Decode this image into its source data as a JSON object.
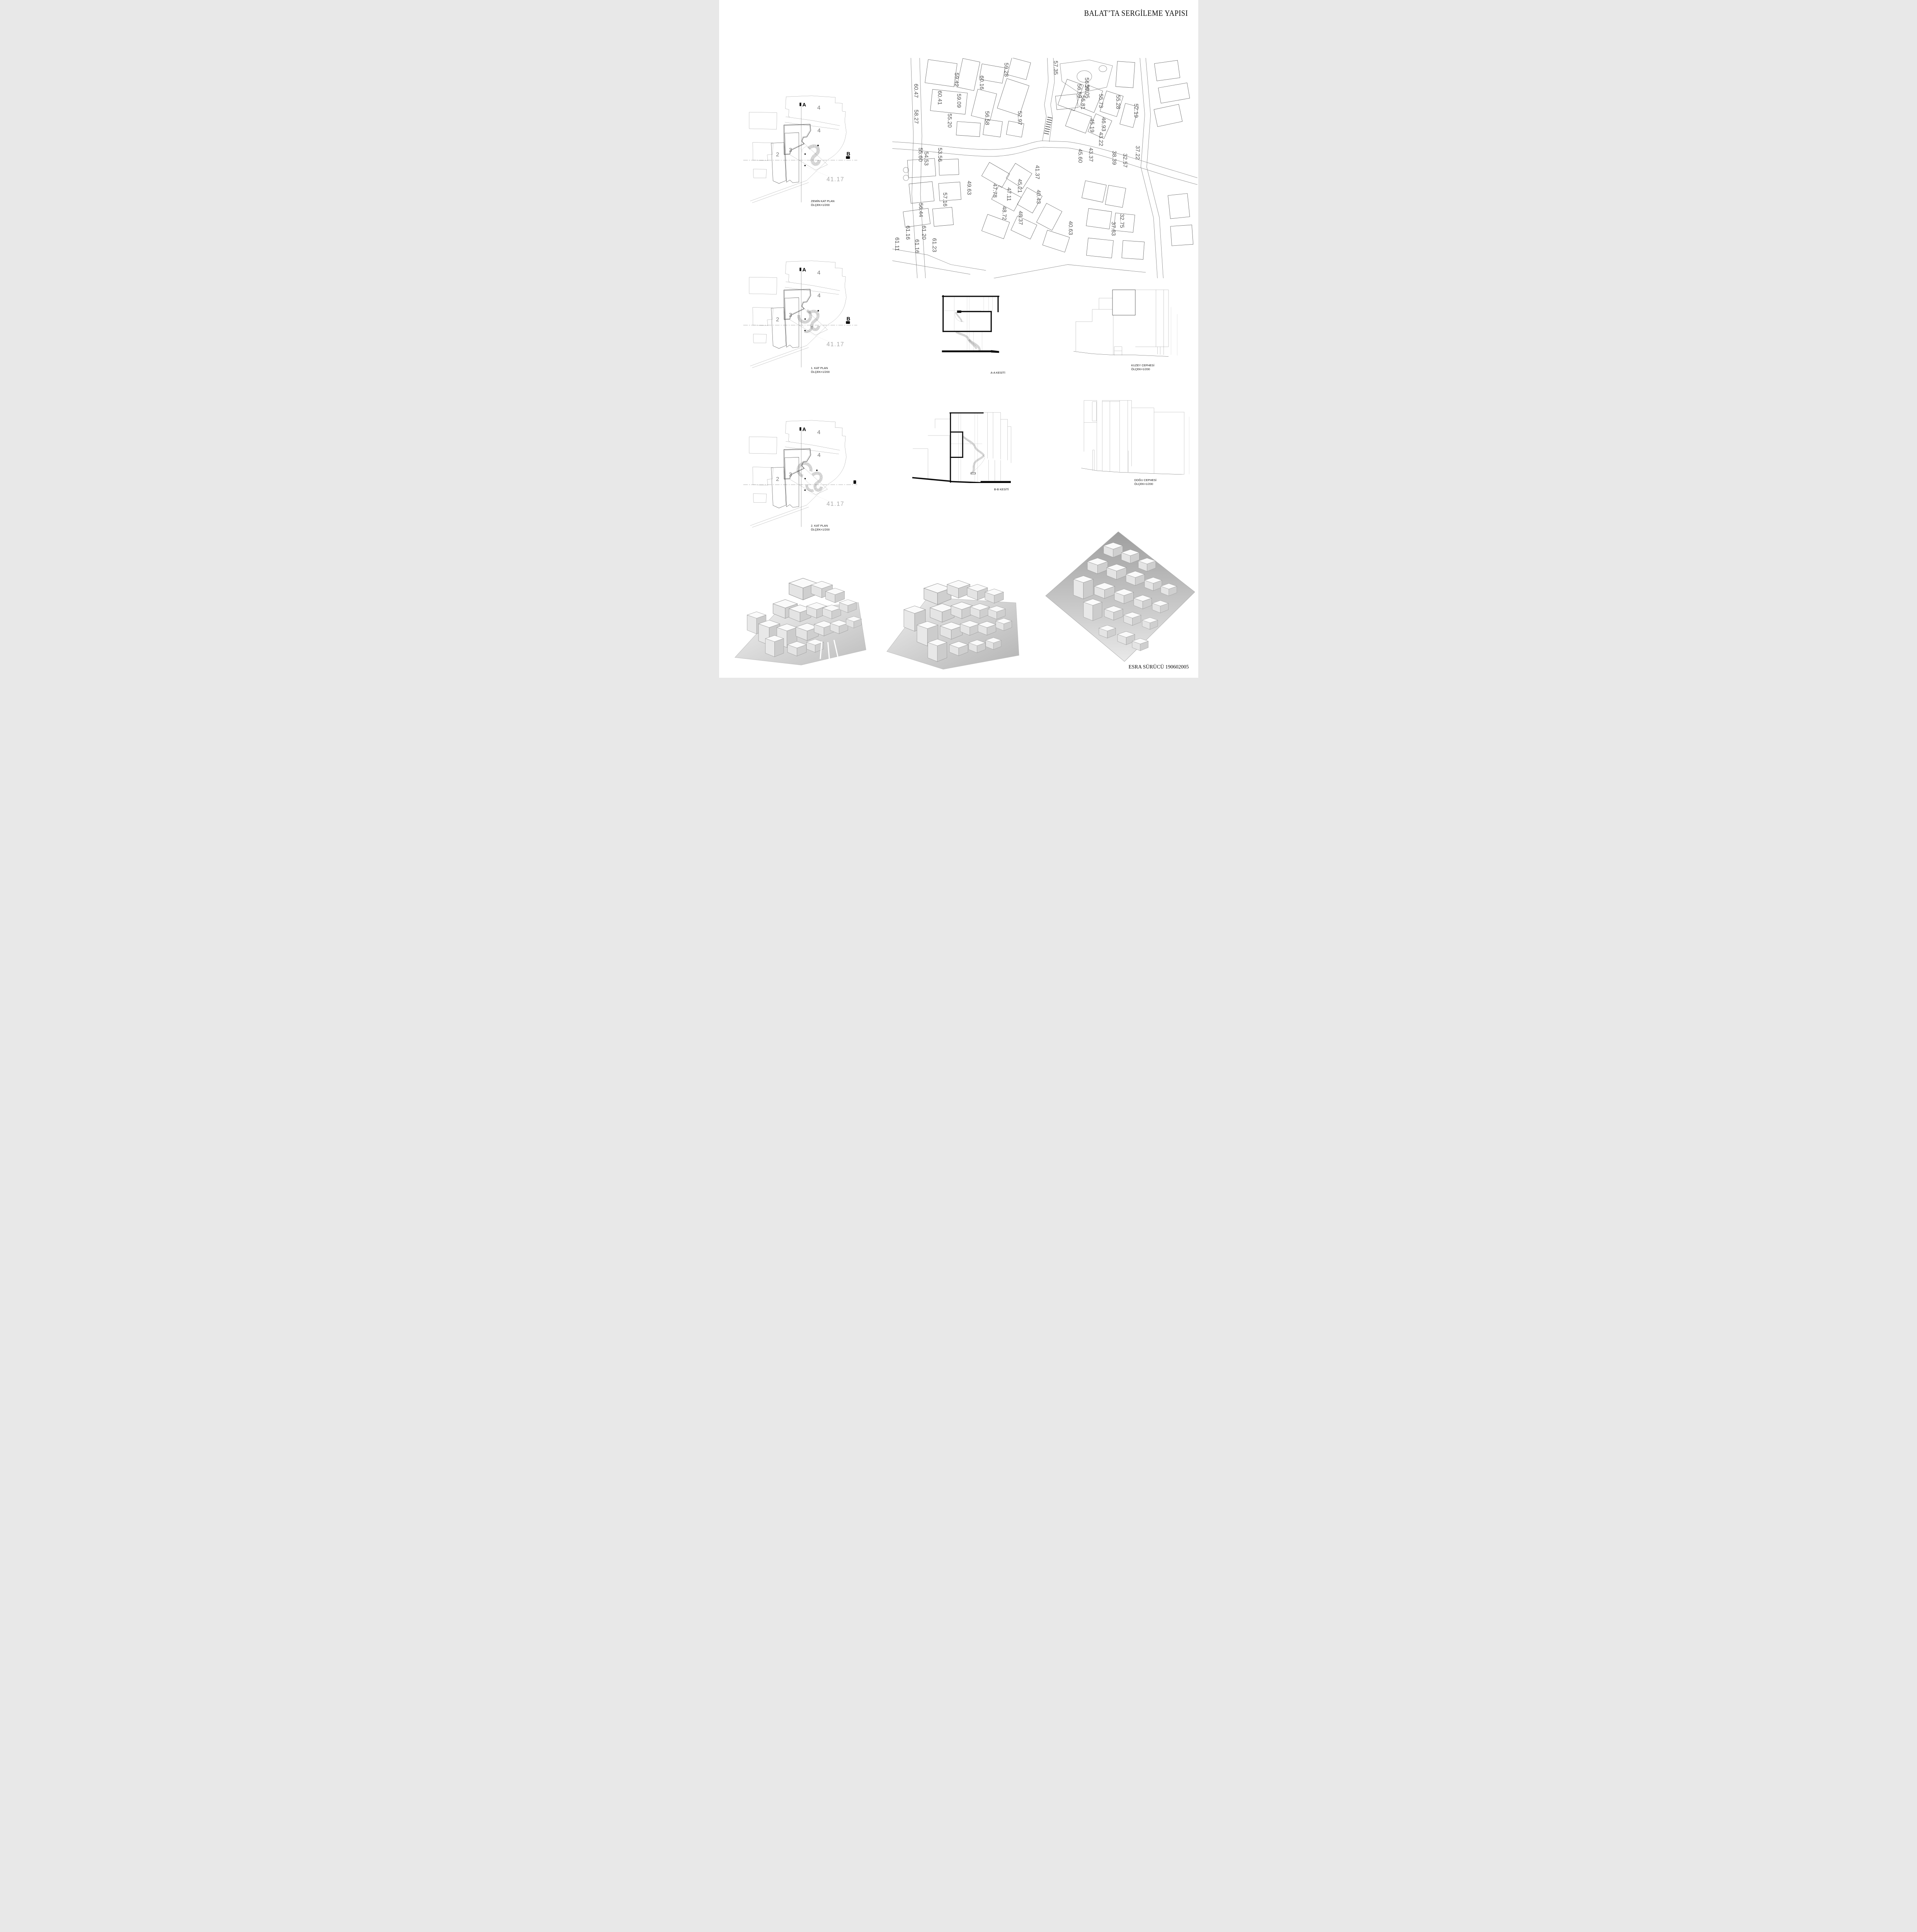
{
  "title": "BALAT’TA SERGİLEME YAPISI",
  "credit": "ESRA SÜRÜCÜ 190602005",
  "plans": [
    {
      "label": "ZEMİN  KAT PLAN",
      "scale": "ÖLÇEK=1/200",
      "marker_a": "A",
      "marker_b": "B",
      "parcel_top": "4",
      "parcel_mid": "4",
      "parcel_3": "3",
      "parcel_2": "2",
      "spot_elevation": "41.17"
    },
    {
      "label": "1. KAT PLAN",
      "scale": "ÖLÇEK=1/200",
      "marker_a": "A",
      "marker_b": "B",
      "parcel_top": "4",
      "parcel_mid": "4",
      "parcel_3": "3",
      "parcel_2": "2",
      "spot_elevation": "41.17"
    },
    {
      "label": "2. KAT PLAN",
      "scale": "ÖLÇEK=1/200",
      "marker_a": "A",
      "marker_b": "",
      "parcel_top": "4",
      "parcel_mid": "4",
      "parcel_3": "3",
      "parcel_2": "2",
      "spot_elevation": "41.17"
    }
  ],
  "sections": [
    {
      "label": "A-A KESİTİ"
    },
    {
      "label": "B-B KESİTİ"
    }
  ],
  "elevations": [
    {
      "label": "KUZEY CEPHESİ",
      "scale": "ÖLÇEK=1/200"
    },
    {
      "label": "DOĞU CEPHESİ",
      "scale": "ÖLÇEK=1/200"
    }
  ],
  "site_map": {
    "labels": [
      "60.47",
      "58.27",
      "60.41",
      "59.42",
      "59.09",
      "55.20",
      "59.28",
      "60.16",
      "57.35",
      "56.27",
      "56.59",
      "56.05",
      "55.81",
      "55.73",
      "55.28",
      "52.19",
      "56.58",
      "52.97",
      "55.60",
      "54.53",
      "53.56",
      "45.19",
      "46.93",
      "43.22",
      "45.60",
      "43.37",
      "41.37",
      "49.63",
      "47.78",
      "47.11",
      "45.21",
      "40.43",
      "40.63",
      "48.72",
      "48.37",
      "57.16",
      "56.44",
      "61.16",
      "61.20",
      "61.11",
      "61.16",
      "61.23",
      "38.39",
      "32.57",
      "37.22",
      "37.83",
      "32.75"
    ]
  }
}
